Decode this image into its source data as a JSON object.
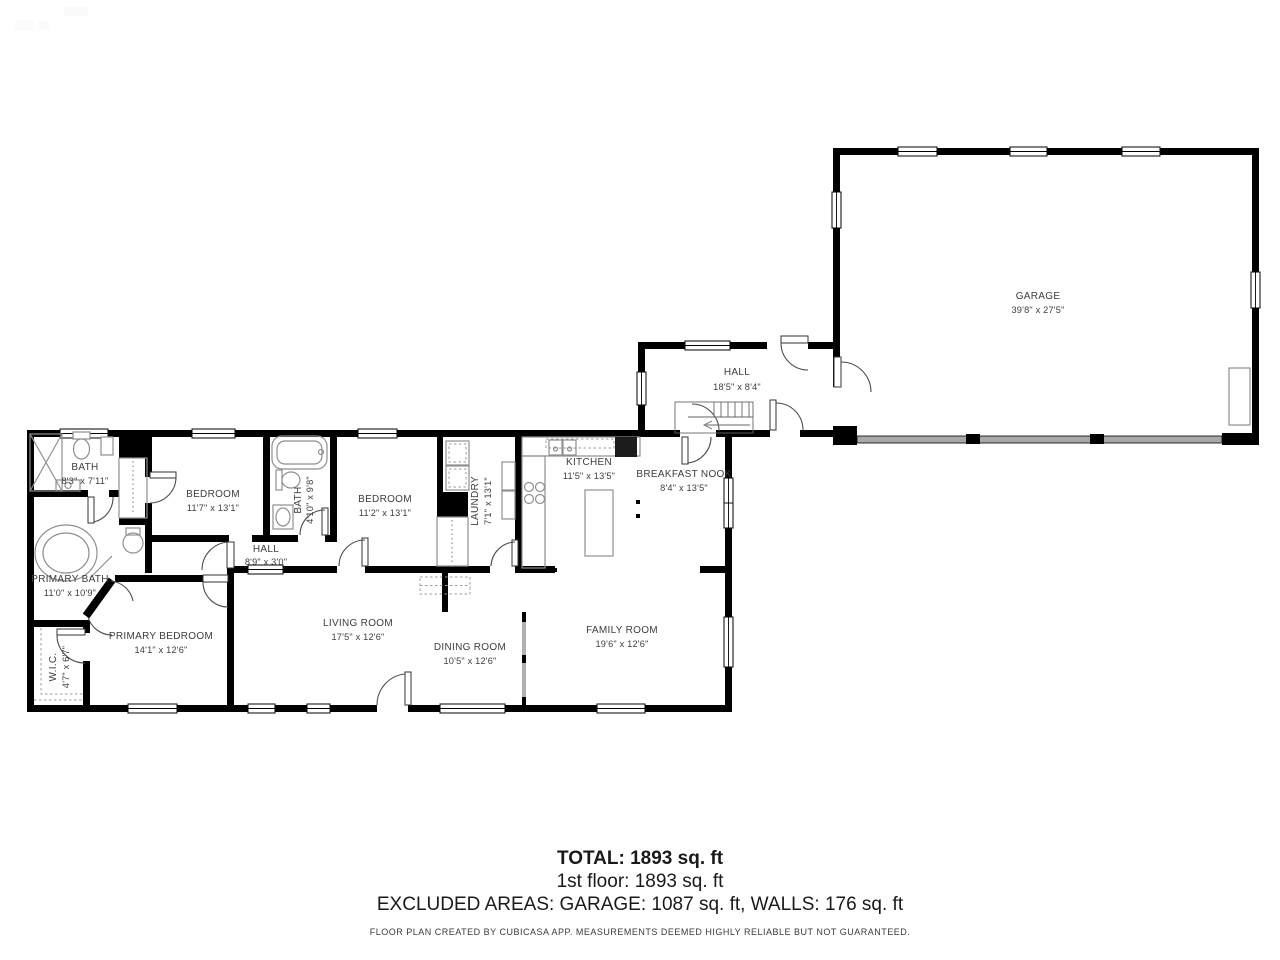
{
  "rooms": [
    {
      "name": "GARAGE",
      "dims": "39'8\" x 27'5\""
    },
    {
      "name": "HALL",
      "dims": "18'5\" x 8'4\""
    },
    {
      "name": "KITCHEN",
      "dims": "11'5\" x 13'5\""
    },
    {
      "name": "BREAKFAST NOOK",
      "dims": "8'4\" x 13'5\""
    },
    {
      "name": "BATH",
      "dims": "8'3\" x 7'11\""
    },
    {
      "name": "BEDROOM",
      "dims": "11'7\" x 13'1\""
    },
    {
      "name": "BATH",
      "dims": "4'10\" x 9'8\""
    },
    {
      "name": "BEDROOM",
      "dims": "11'2\" x 13'1\""
    },
    {
      "name": "LAUNDRY",
      "dims": "7'1\" x 13'1\""
    },
    {
      "name": "HALL",
      "dims": "8'9\" x 3'0\""
    },
    {
      "name": "PRIMARY BATH",
      "dims": "11'0\" x 10'9\""
    },
    {
      "name": "PRIMARY BEDROOM",
      "dims": "14'1\" x 12'6\""
    },
    {
      "name": "W.I.C.",
      "dims": "4'7\" x 6'7\""
    },
    {
      "name": "LIVING ROOM",
      "dims": "17'5\" x 12'6\""
    },
    {
      "name": "DINING ROOM",
      "dims": "10'5\" x 12'6\""
    },
    {
      "name": "FAMILY ROOM",
      "dims": "19'6\" x 12'6\""
    }
  ],
  "summary": {
    "total": "TOTAL: 1893 sq. ft",
    "floor": "1st floor: 1893 sq. ft",
    "excluded": "EXCLUDED AREAS: GARAGE: 1087 sq. ft, WALLS: 176 sq. ft",
    "disclaimer": "FLOOR PLAN CREATED BY CUBICASA APP. MEASUREMENTS DEEMED HIGHLY RELIABLE BUT NOT GUARANTEED."
  },
  "colors": {
    "wall": "#000000",
    "garage_door_band": "#a8a8a8",
    "fixture_stroke": "#8f8f8f",
    "label_text": "#3d3d3d"
  }
}
